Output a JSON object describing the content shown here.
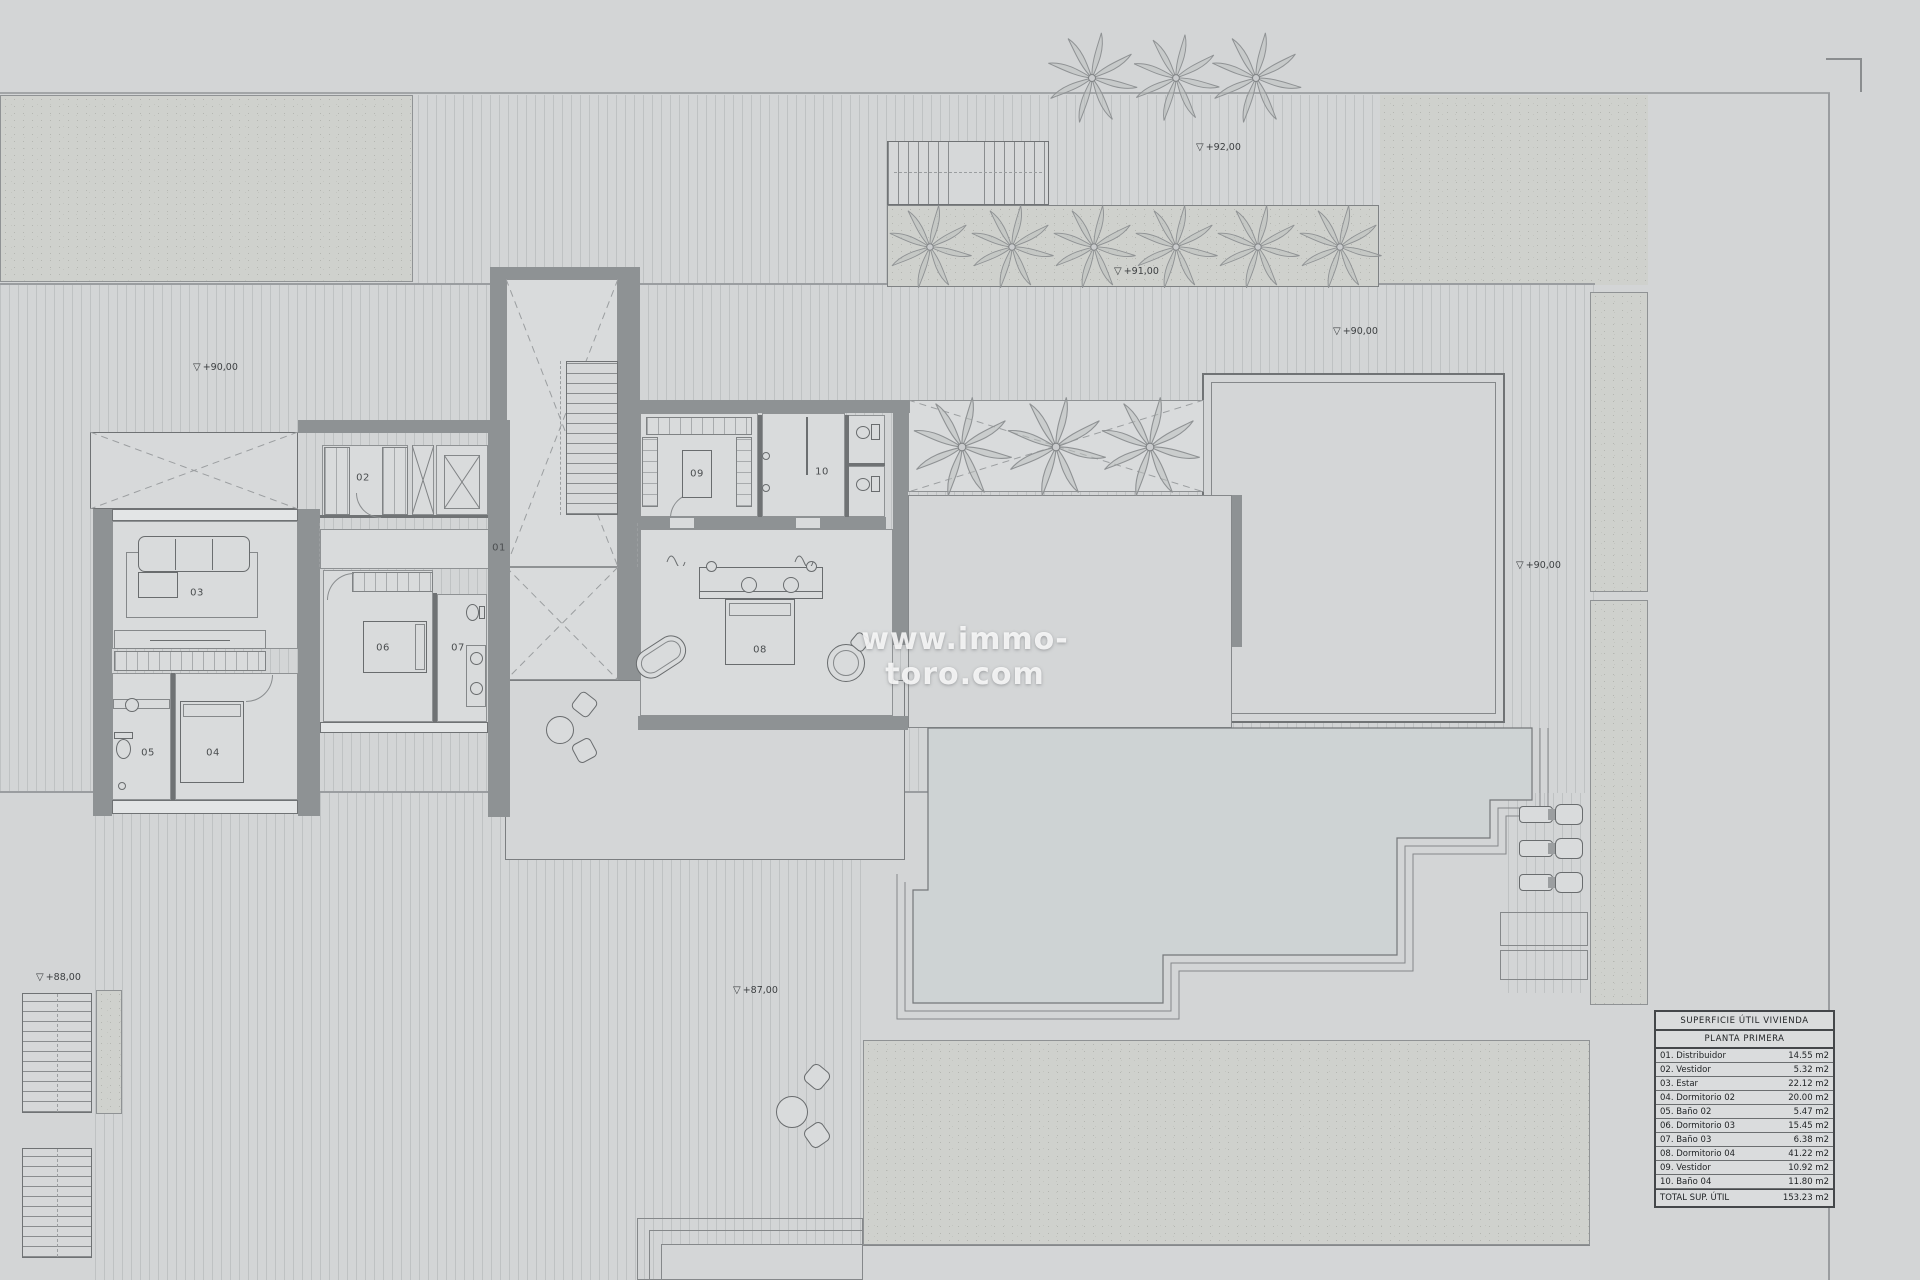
{
  "watermark": "www.immo-toro.com",
  "room_labels": {
    "r01": "01",
    "r02": "02",
    "r03": "03",
    "r04": "04",
    "r05": "05",
    "r06": "06",
    "r07": "07",
    "r08": "08",
    "r09": "09",
    "r10": "10"
  },
  "markers": [
    {
      "glyph": "▽",
      "text": "+90,00"
    },
    {
      "glyph": "▽",
      "text": "+92,00"
    },
    {
      "glyph": "▽",
      "text": "+91,00"
    },
    {
      "glyph": "▽",
      "text": "+90,00"
    },
    {
      "glyph": "▽",
      "text": "+90,00"
    },
    {
      "glyph": "▽",
      "text": "+87,00"
    },
    {
      "glyph": "▽",
      "text": "+88,00"
    }
  ],
  "area_table": {
    "title": "SUPERFICIE ÚTIL VIVIENDA",
    "subtitle": "PLANTA PRIMERA",
    "rows": [
      {
        "name": "01. Distribuidor",
        "area": "14.55 m2"
      },
      {
        "name": "02. Vestidor",
        "area": "5.32 m2"
      },
      {
        "name": "03. Estar",
        "area": "22.12 m2"
      },
      {
        "name": "04. Dormitorio 02",
        "area": "20.00 m2"
      },
      {
        "name": "05. Baño 02",
        "area": "5.47 m2"
      },
      {
        "name": "06. Dormitorio 03",
        "area": "15.45 m2"
      },
      {
        "name": "07. Baño 03",
        "area": "6.38 m2"
      },
      {
        "name": "08. Dormitorio 04",
        "area": "41.22 m2"
      },
      {
        "name": "09. Vestidor",
        "area": "10.92 m2"
      },
      {
        "name": "10. Baño 04",
        "area": "11.80 m2"
      }
    ],
    "total": {
      "name": "TOTAL SUP. ÚTIL",
      "area": "153.23 m2"
    }
  }
}
